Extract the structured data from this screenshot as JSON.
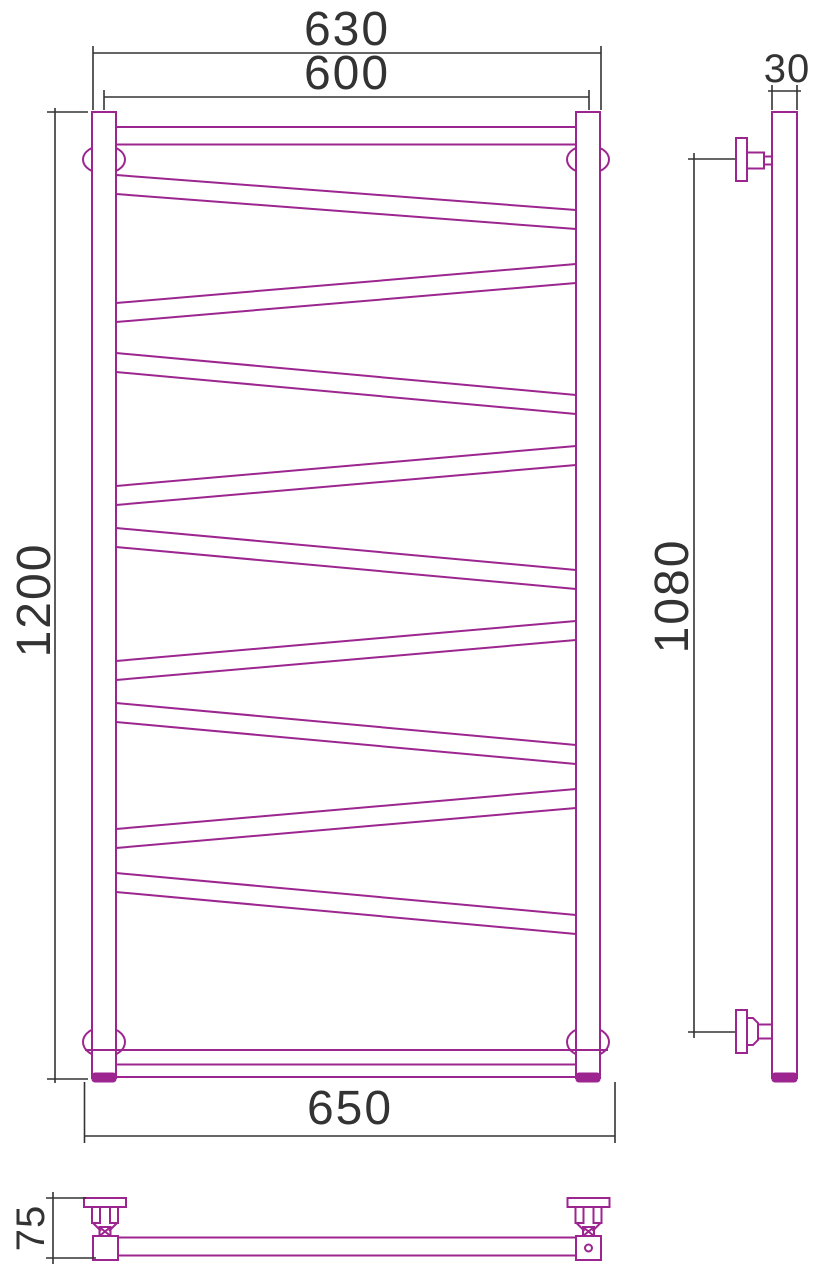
{
  "drawing": {
    "type": "technical-drawing",
    "subject": "heated-towel-rail-zigzag",
    "colors": {
      "object_line": "#9c2590",
      "dimension_line": "#333333",
      "background": "#ffffff"
    },
    "dimensions": {
      "width_overall_top": "630",
      "width_mounting": "600",
      "height_overall": "1200",
      "width_bottom": "650",
      "tube_width": "30",
      "height_mounting": "1080",
      "depth_wall_offset": "75"
    }
  }
}
